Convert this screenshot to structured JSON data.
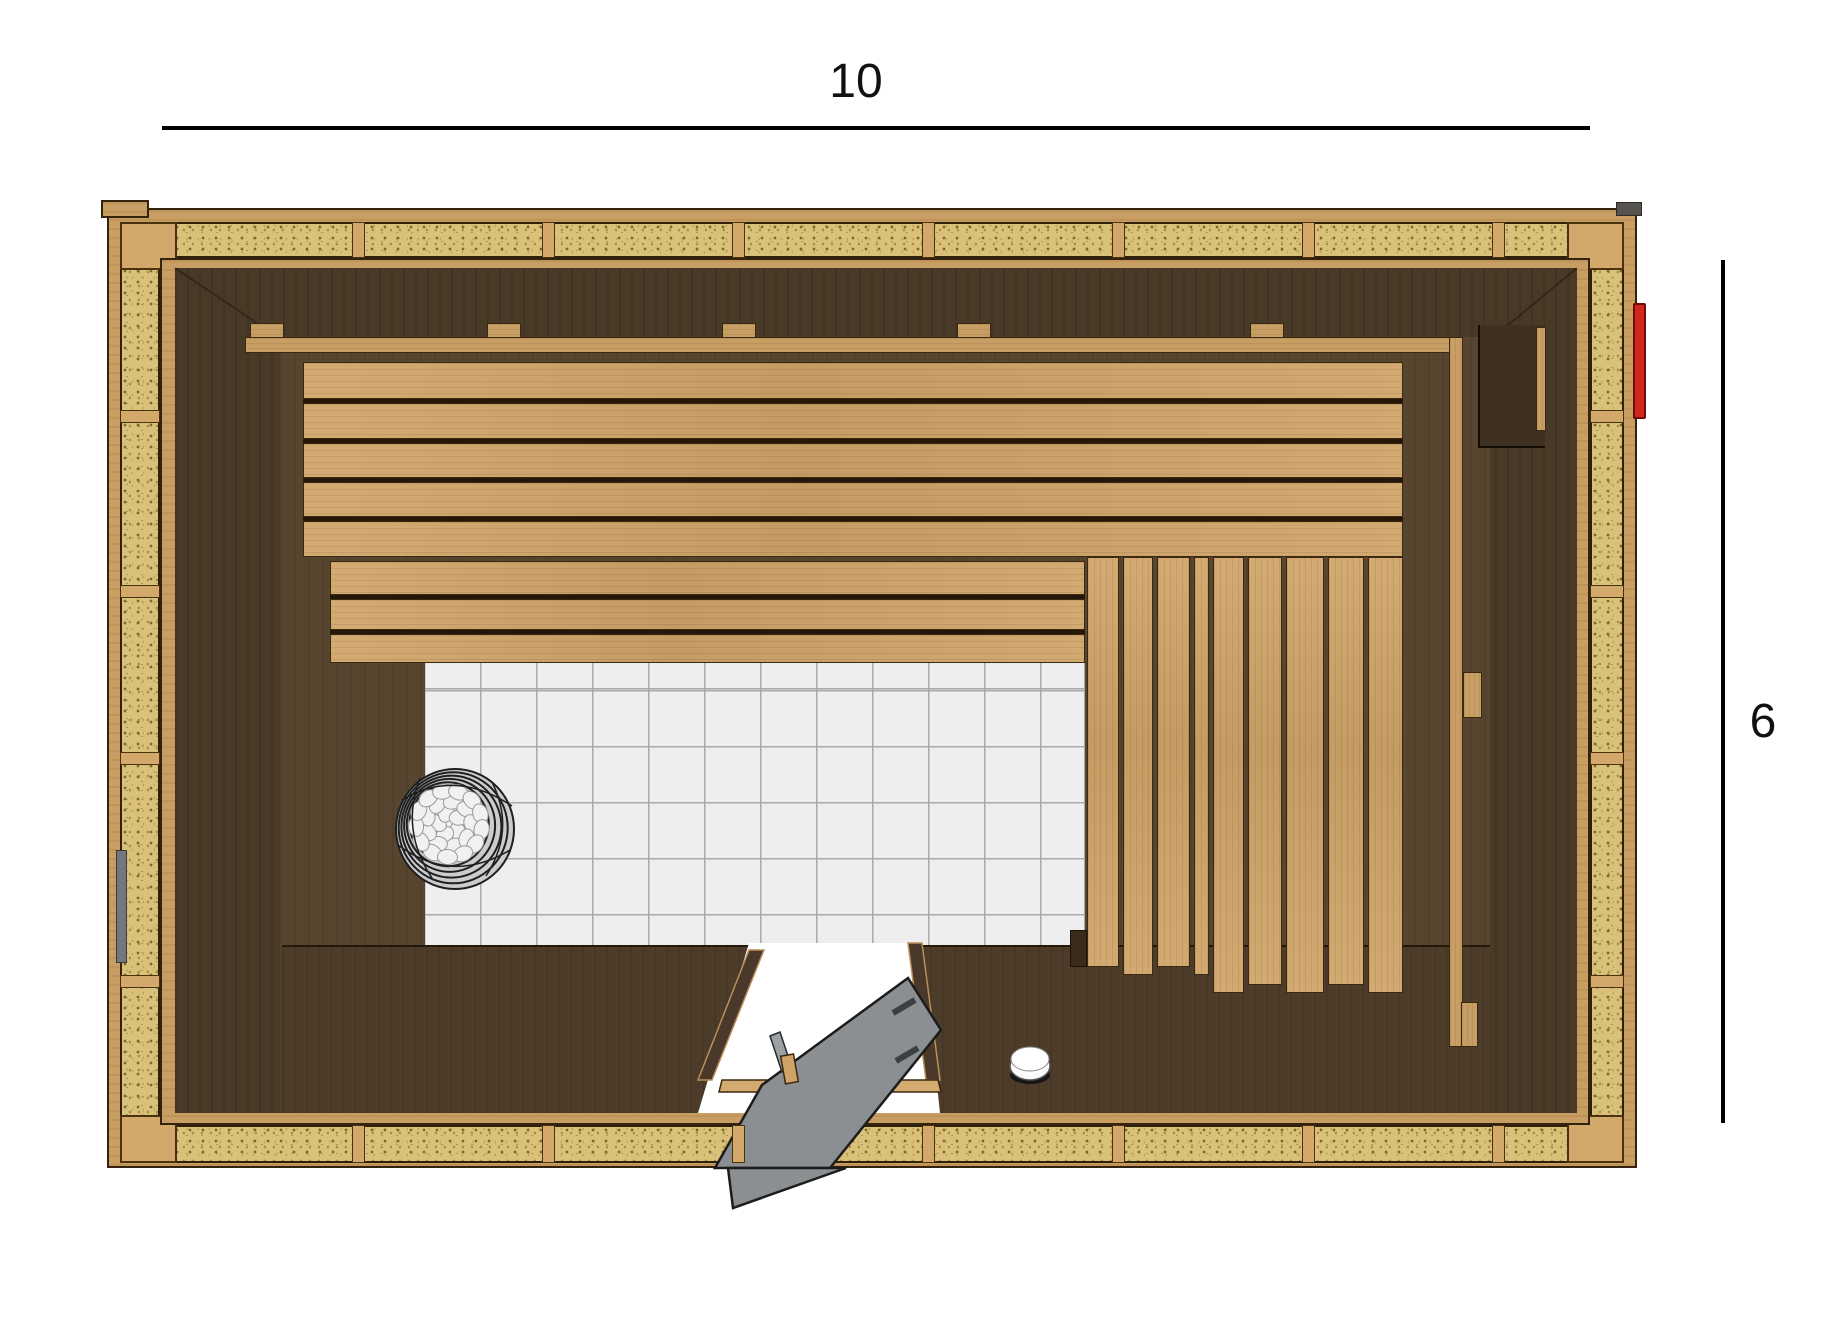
{
  "title": "sauna-floor-plan",
  "dimensions": {
    "width_label": "10",
    "height_label": "6"
  },
  "colors": {
    "outer_wood": "#c99e63",
    "insulation": "#d9c17a",
    "stud": "#d2a96a",
    "interior_wall": "#493927",
    "interior_floor": "#57452f",
    "platform": "#4e3c2a",
    "bench_wood": "#cfa468",
    "tile": "#eeeeee",
    "tile_line": "#a9a9a9",
    "door_leaf": "#8b8f92",
    "heater_stone": "#f1f1f1",
    "heater_wire": "#1f1f1f",
    "accent_red": "#d2271c",
    "vent_gray": "#73767c",
    "dimension_line": "#000000"
  },
  "geometry": {
    "upper_bench": {
      "x": 303,
      "w": 1100,
      "rows": [
        [
          362,
          37
        ],
        [
          403,
          36
        ],
        [
          443,
          35
        ],
        [
          482,
          35
        ],
        [
          521,
          36
        ]
      ]
    },
    "lower_bench": {
      "x": 330,
      "w": 755,
      "rows": [
        [
          561,
          34
        ],
        [
          599,
          31
        ],
        [
          634,
          29
        ]
      ]
    },
    "vertical_planks": {
      "y": 557,
      "items": [
        [
          1087,
          32,
          410
        ],
        [
          1123,
          30,
          418
        ],
        [
          1157,
          33,
          410
        ],
        [
          1194,
          15,
          418
        ],
        [
          1213,
          31,
          436
        ],
        [
          1248,
          34,
          428
        ],
        [
          1286,
          38,
          436
        ],
        [
          1328,
          36,
          428
        ],
        [
          1368,
          35,
          436
        ]
      ]
    },
    "rail_blocks_x": [
      250,
      487,
      722,
      957,
      1250
    ],
    "wall_studs_top_x": [
      352,
      542,
      732,
      922,
      1112,
      1302,
      1492
    ],
    "wall_studs_side_y": [
      410,
      585,
      752,
      975
    ]
  }
}
